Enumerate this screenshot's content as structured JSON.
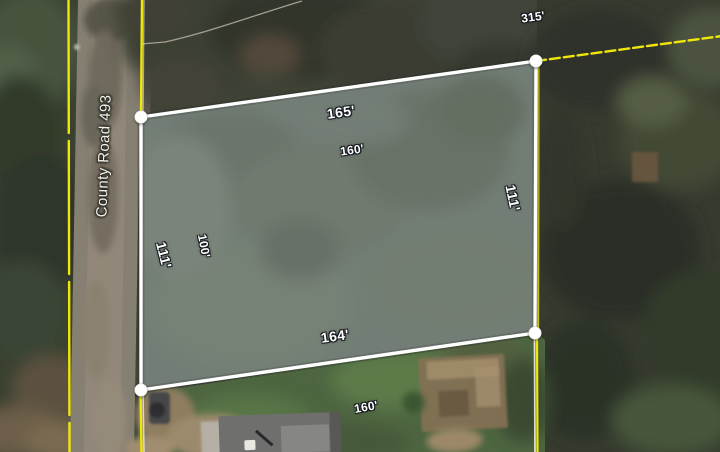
{
  "map": {
    "road": {
      "name": "County Road 493"
    },
    "parcel": {
      "side_lengths": {
        "top": "165'",
        "right": "111'",
        "bottom": "164'",
        "left": "111'"
      }
    },
    "adjacent": {
      "top": "160'",
      "left": "100'",
      "bottom": "160'",
      "northeast_boundary": "315'"
    },
    "colors": {
      "boundary_yellow": "#f0e60a",
      "parcel_outline": "#ffffff",
      "parcel_fill": "rgba(255,255,255,0.17)",
      "parcel_halo": "rgba(38,43,38,0.35)",
      "vertex_fill": "#ffffff"
    }
  }
}
